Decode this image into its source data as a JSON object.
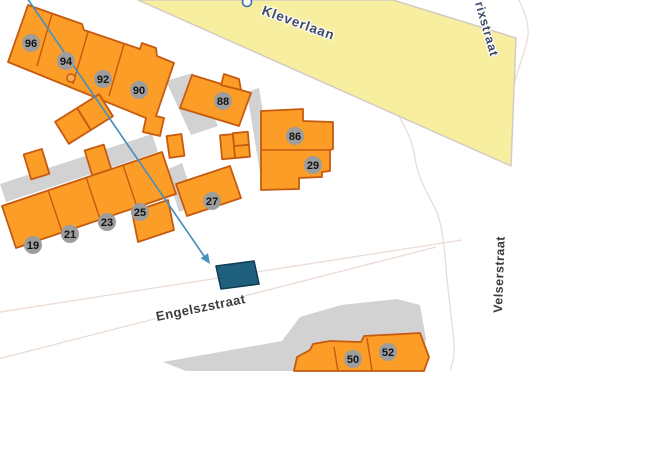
{
  "colors": {
    "page_bg": "#FFFFFF",
    "building_fill": "#FB9D26",
    "building_stroke": "#C65A10",
    "road_fill": "#F8EE9F",
    "road_stroke": "#D5CBC2",
    "shadow_fill": "#D2D2D2",
    "badge_fill": "#9D9D9D",
    "badge_text": "#141414",
    "label_main": "#3E4A68",
    "label_minor": "#3C3C3C",
    "arrow": "#4A90BE",
    "highlight_fill": "#20607F",
    "highlight_stroke": "#123D53",
    "faint_line": "#EADCD4",
    "marker_fill": "#FBAE54",
    "poi_ring": "#3A6FB8"
  },
  "streets": {
    "kleverlaan": "Kleverlaan",
    "rixstraat": "rixstraat",
    "velserstraat": "Velserstraat",
    "engelszstraat": "Engelszstraat"
  },
  "house_numbers": {
    "n96": "96",
    "n94": "94",
    "n92": "92",
    "n90": "90",
    "n88": "88",
    "n86": "86",
    "n29": "29",
    "n27": "27",
    "n25": "25",
    "n23": "23",
    "n21": "21",
    "n19": "19",
    "n50": "50",
    "n52": "52"
  }
}
